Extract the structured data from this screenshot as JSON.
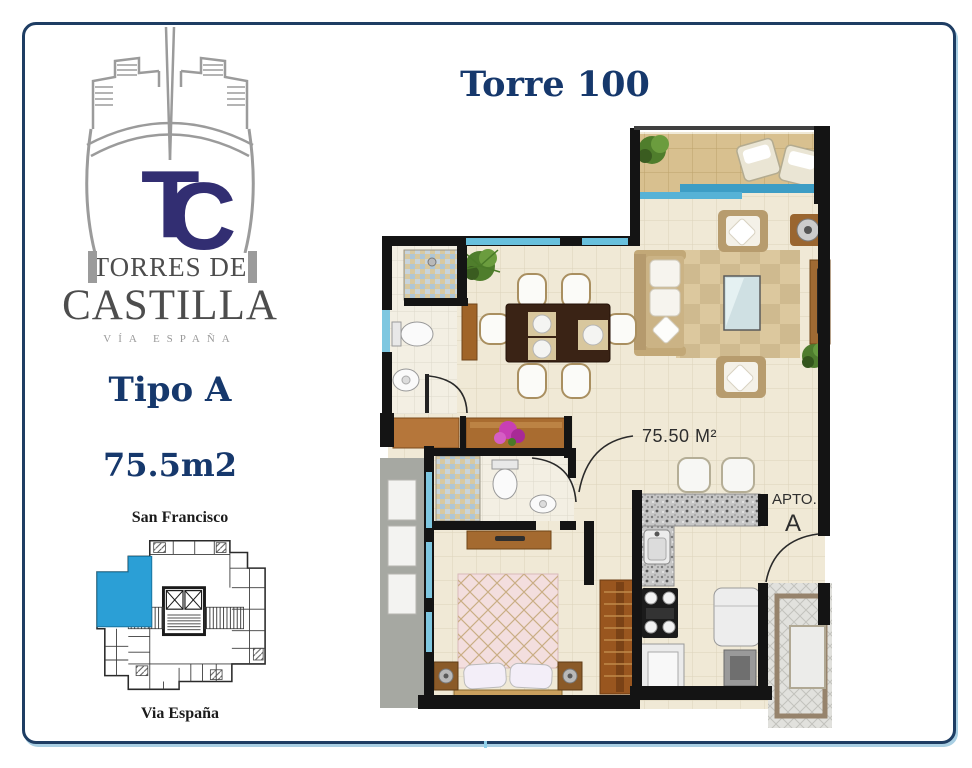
{
  "brand": {
    "monogram_t": "T",
    "monogram_c": "C",
    "name_line1": "TORRES DE",
    "name_line2": "CASTILLA",
    "tagline": "VÍA ESPAÑA"
  },
  "unit": {
    "type_label": "Tipo A",
    "area_label": "75.5m2"
  },
  "tower": {
    "title": "Torre 100"
  },
  "keyplan": {
    "top_label": "San Francisco",
    "bottom_label": "Via España",
    "highlight_color": "#2b9fd6"
  },
  "floorplan": {
    "area_label": "75.50 M²",
    "apt_label": "APTO.",
    "apt_letter": "A"
  },
  "colors": {
    "navy_text": "#16386c",
    "logo_monogram": "#322e72",
    "logo_gray": "#9b9b9b",
    "brand_gray": "#4d4d4d",
    "tagline_gray": "#9a9a9a",
    "border_navy": "#1e3d63",
    "border_light": "#a9cfe3",
    "wall_black": "#141414",
    "floor_beige": "#f0e9d6",
    "balcony_tan": "#d8c08f",
    "window_blue": "#57b2d6",
    "highlight_blue": "#2b9fd6"
  }
}
